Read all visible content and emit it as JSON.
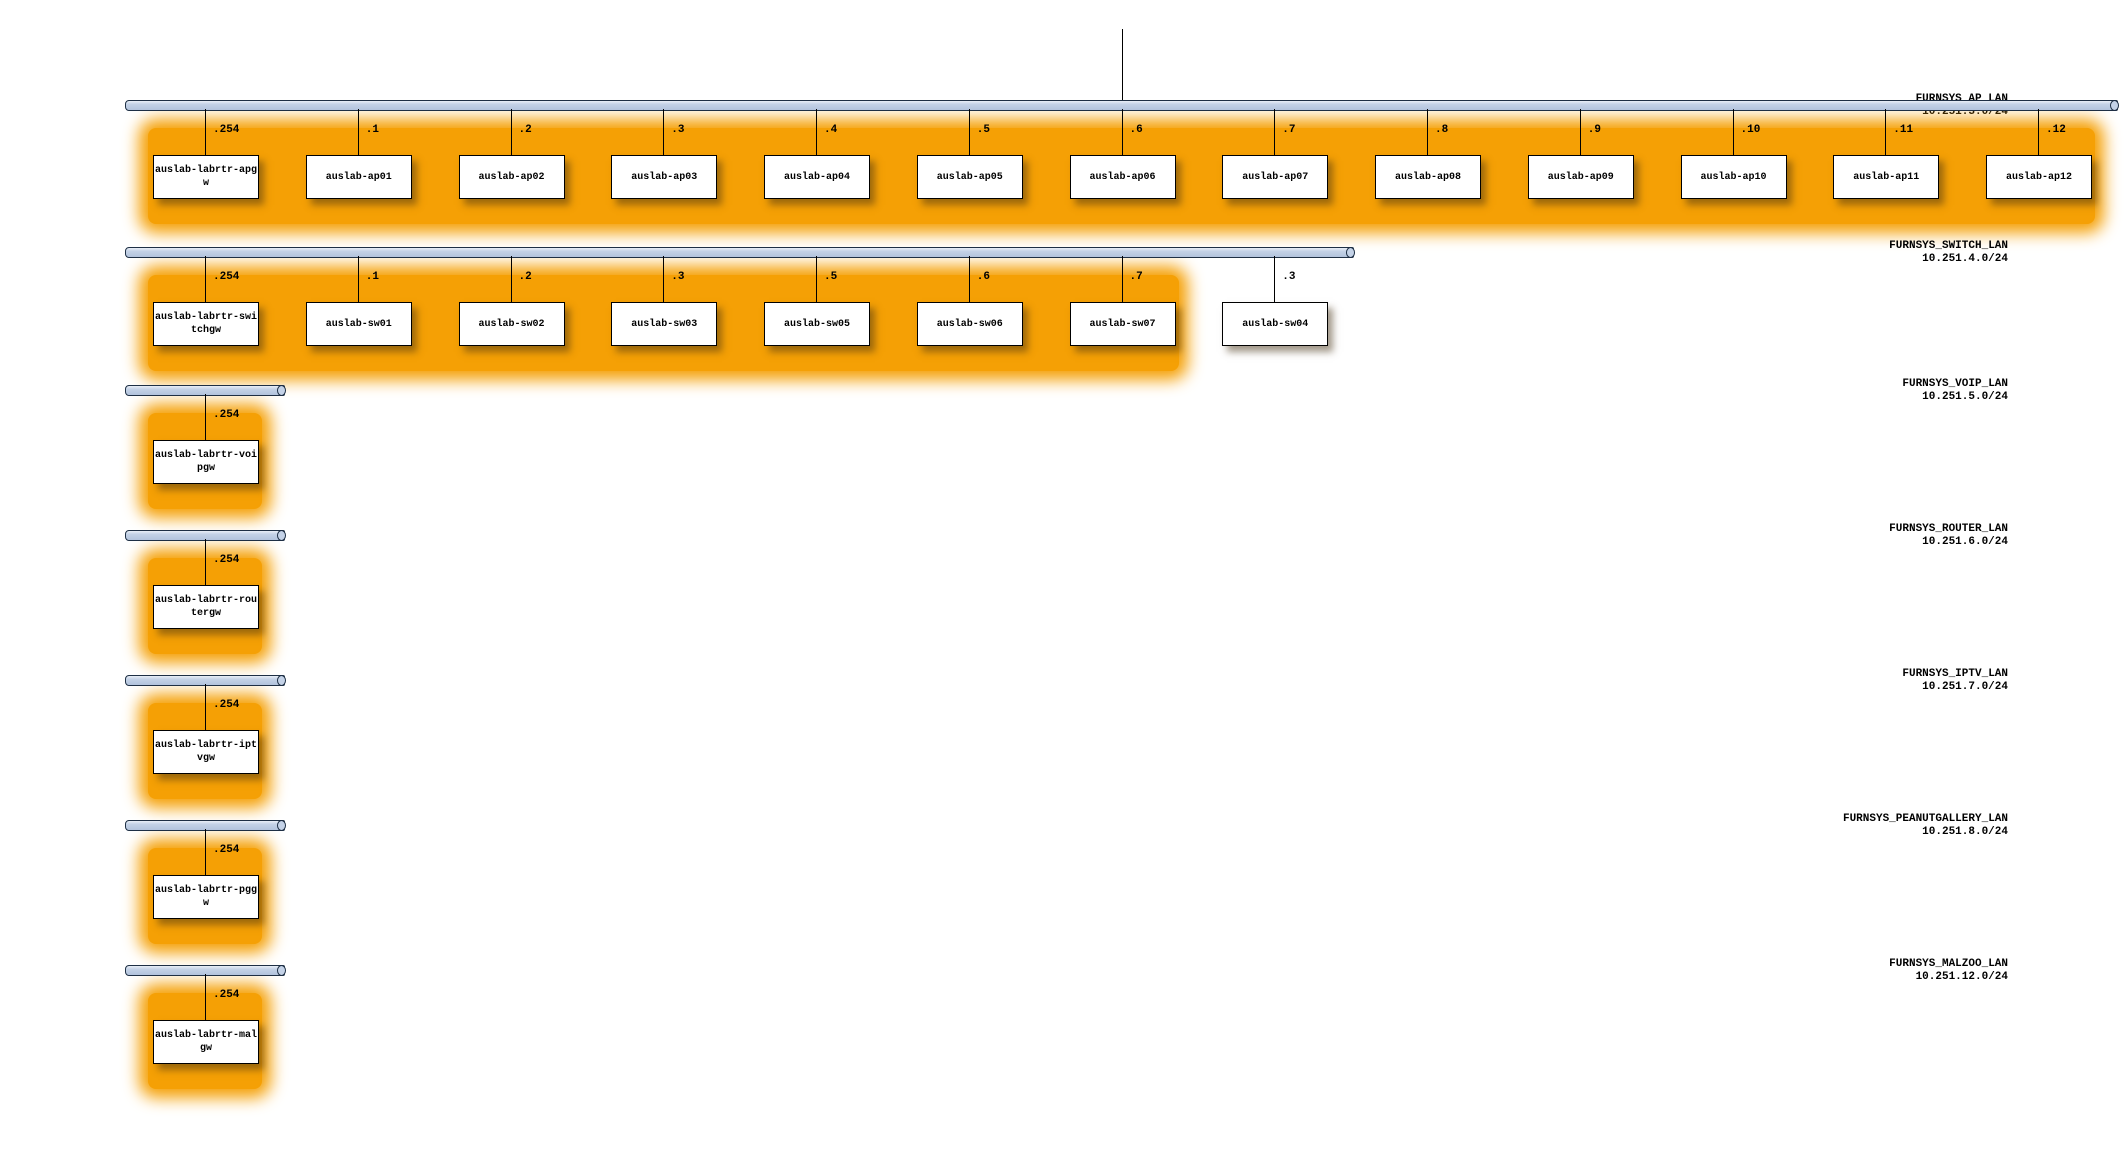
{
  "diagram": {
    "colors": {
      "background": "#ffffff",
      "network_bar_fill": "#c4d2e7",
      "network_bar_border": "#1e2f44",
      "group_highlight": "#f5a005",
      "node_fill": "#ffffff",
      "node_border": "#000000",
      "text": "#000000"
    },
    "networks": [
      {
        "name": "FURNSYS_AP_LAN",
        "subnet": "10.251.3.0/24",
        "uplink": true,
        "nodes": [
          {
            "lines": [
              "auslab-labrtr-apg",
              "w"
            ],
            "address": ".254",
            "highlighted": true
          },
          {
            "lines": [
              "auslab-ap01"
            ],
            "address": ".1",
            "highlighted": true
          },
          {
            "lines": [
              "auslab-ap02"
            ],
            "address": ".2",
            "highlighted": true
          },
          {
            "lines": [
              "auslab-ap03"
            ],
            "address": ".3",
            "highlighted": true
          },
          {
            "lines": [
              "auslab-ap04"
            ],
            "address": ".4",
            "highlighted": true
          },
          {
            "lines": [
              "auslab-ap05"
            ],
            "address": ".5",
            "highlighted": true
          },
          {
            "lines": [
              "auslab-ap06"
            ],
            "address": ".6",
            "highlighted": true
          },
          {
            "lines": [
              "auslab-ap07"
            ],
            "address": ".7",
            "highlighted": true
          },
          {
            "lines": [
              "auslab-ap08"
            ],
            "address": ".8",
            "highlighted": true
          },
          {
            "lines": [
              "auslab-ap09"
            ],
            "address": ".9",
            "highlighted": true
          },
          {
            "lines": [
              "auslab-ap10"
            ],
            "address": ".10",
            "highlighted": true
          },
          {
            "lines": [
              "auslab-ap11"
            ],
            "address": ".11",
            "highlighted": true
          },
          {
            "lines": [
              "auslab-ap12"
            ],
            "address": ".12",
            "highlighted": true
          }
        ]
      },
      {
        "name": "FURNSYS_SWITCH_LAN",
        "subnet": "10.251.4.0/24",
        "uplink": false,
        "nodes": [
          {
            "lines": [
              "auslab-labrtr-swi",
              "tchgw"
            ],
            "address": ".254",
            "highlighted": true
          },
          {
            "lines": [
              "auslab-sw01"
            ],
            "address": ".1",
            "highlighted": true
          },
          {
            "lines": [
              "auslab-sw02"
            ],
            "address": ".2",
            "highlighted": true
          },
          {
            "lines": [
              "auslab-sw03"
            ],
            "address": ".3",
            "highlighted": true
          },
          {
            "lines": [
              "auslab-sw05"
            ],
            "address": ".5",
            "highlighted": true
          },
          {
            "lines": [
              "auslab-sw06"
            ],
            "address": ".6",
            "highlighted": true
          },
          {
            "lines": [
              "auslab-sw07"
            ],
            "address": ".7",
            "highlighted": true
          },
          {
            "lines": [
              "auslab-sw04"
            ],
            "address": ".3",
            "highlighted": false
          }
        ]
      },
      {
        "name": "FURNSYS_VOIP_LAN",
        "subnet": "10.251.5.0/24",
        "uplink": false,
        "nodes": [
          {
            "lines": [
              "auslab-labrtr-voi",
              "pgw"
            ],
            "address": ".254",
            "highlighted": true
          }
        ]
      },
      {
        "name": "FURNSYS_ROUTER_LAN",
        "subnet": "10.251.6.0/24",
        "uplink": false,
        "nodes": [
          {
            "lines": [
              "auslab-labrtr-rou",
              "tergw"
            ],
            "address": ".254",
            "highlighted": true
          }
        ]
      },
      {
        "name": "FURNSYS_IPTV_LAN",
        "subnet": "10.251.7.0/24",
        "uplink": false,
        "nodes": [
          {
            "lines": [
              "auslab-labrtr-ipt",
              "vgw"
            ],
            "address": ".254",
            "highlighted": true
          }
        ]
      },
      {
        "name": "FURNSYS_PEANUTGALLERY_LAN",
        "subnet": "10.251.8.0/24",
        "uplink": false,
        "nodes": [
          {
            "lines": [
              "auslab-labrtr-pgg",
              "w"
            ],
            "address": ".254",
            "highlighted": true
          }
        ]
      },
      {
        "name": "FURNSYS_MALZOO_LAN",
        "subnet": "10.251.12.0/24",
        "uplink": false,
        "nodes": [
          {
            "lines": [
              "auslab-labrtr-mal",
              "gw"
            ],
            "address": ".254",
            "highlighted": true
          }
        ]
      }
    ]
  }
}
